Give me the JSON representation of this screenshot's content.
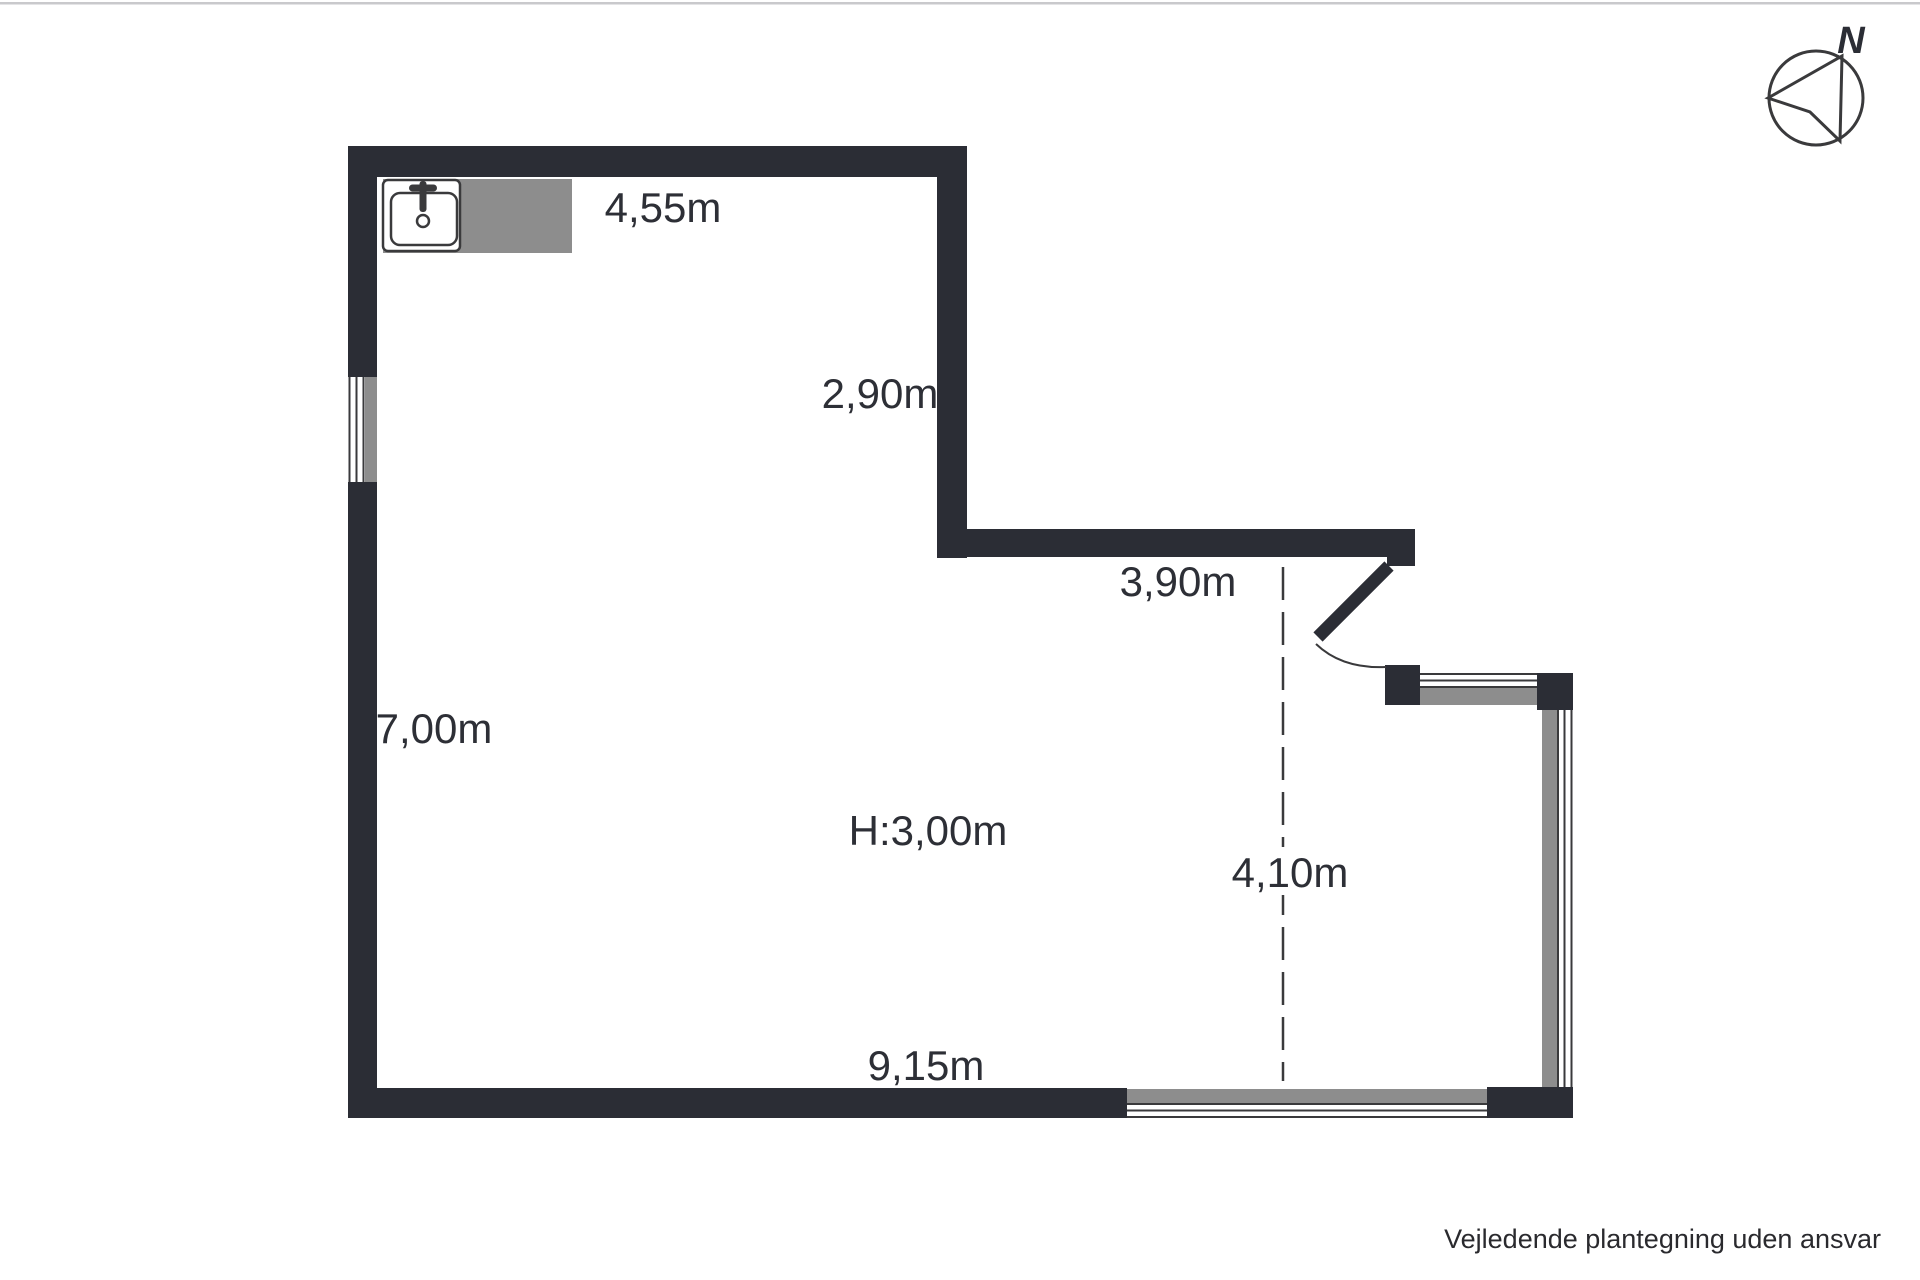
{
  "colors": {
    "wall": "#2b2d35",
    "gray": "#8d8d8d",
    "text": "#2d2f36",
    "line": "#3a3a3c",
    "border": "#c9c9cc"
  },
  "compass": {
    "north_label": "N"
  },
  "labels": {
    "dim_top_width": "4,55m",
    "dim_upper_right_height": "2,90m",
    "dim_mid_width": "3,90m",
    "dim_left_height": "7,00m",
    "dim_ceiling_height": "H:3,00m",
    "dim_right_height": "4,10m",
    "dim_bottom_width": "9,15m"
  },
  "footer": {
    "disclaimer": "Vejledende plantegning uden ansvar"
  }
}
